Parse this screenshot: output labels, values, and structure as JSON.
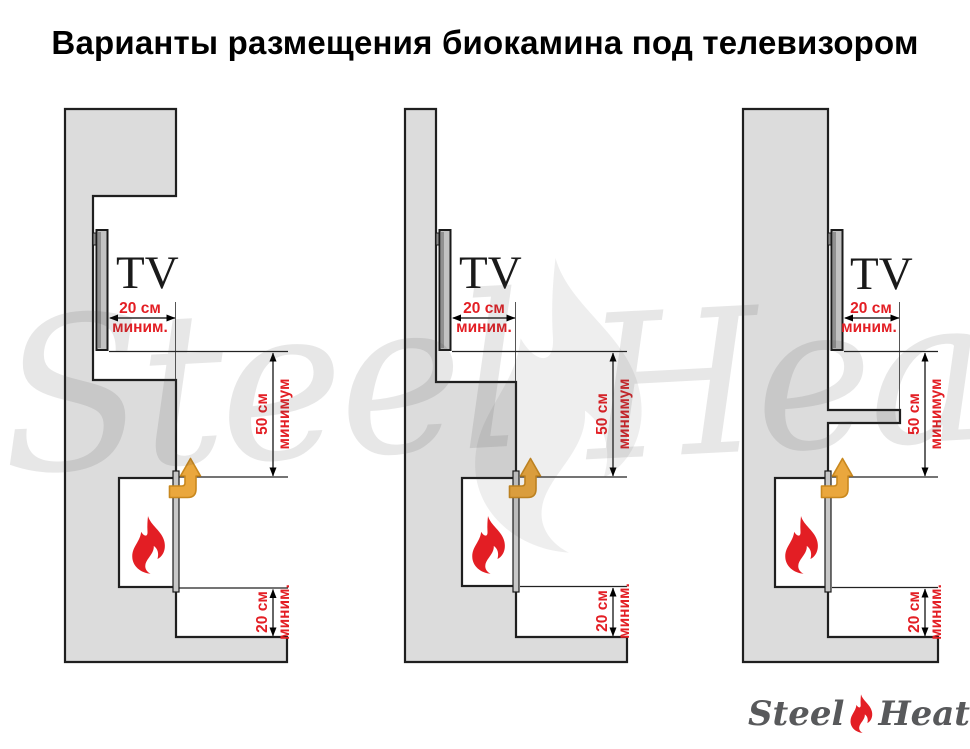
{
  "title": "Варианты размещения биокамина под телевизором",
  "watermark": {
    "left_word": "Steel",
    "right_word": "Heat"
  },
  "logo": {
    "left_word": "Steel",
    "right_word": "Heat"
  },
  "colors": {
    "dimension_red": "#e31e24",
    "flame_red": "#e31e24",
    "heat_arrow_orange": "#eaa73d",
    "heat_arrow_outline": "#c9881e",
    "wall_gray": "#dcdcdc",
    "logo_text_gray": "#58595b"
  },
  "diagrams": [
    {
      "tv_label": "TV",
      "top_clearance": {
        "value": "20 см",
        "qualifier": "миним."
      },
      "middle_clearance": {
        "value": "50 см",
        "qualifier": "минимум"
      },
      "bottom_clearance": {
        "value": "20 см",
        "qualifier": "миним."
      }
    },
    {
      "tv_label": "TV",
      "top_clearance": {
        "value": "20 см",
        "qualifier": "миним."
      },
      "middle_clearance": {
        "value": "50 см",
        "qualifier": "минимум"
      },
      "bottom_clearance": {
        "value": "20 см",
        "qualifier": "миним."
      }
    },
    {
      "tv_label": "TV",
      "top_clearance": {
        "value": "20 см",
        "qualifier": "миним."
      },
      "middle_clearance": {
        "value": "50 см",
        "qualifier": "минимум"
      },
      "bottom_clearance": {
        "value": "20 см",
        "qualifier": "миним."
      }
    }
  ]
}
